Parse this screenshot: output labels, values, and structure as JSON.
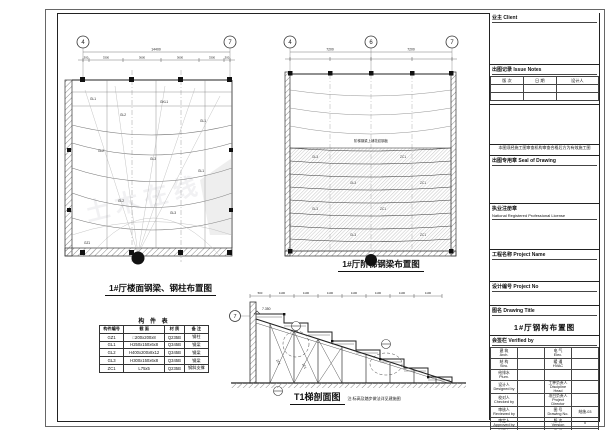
{
  "watermark": {
    "text": "土木在线"
  },
  "plan1": {
    "caption": "1#厅楼面钢梁、钢柱布置图",
    "grid_bubbles": [
      "4",
      "7"
    ],
    "dim_total": "14400",
    "dim_segments": [
      "300",
      "3300",
      "3600",
      "3600",
      "3300",
      "300"
    ],
    "labels": {
      "column": "GZ1",
      "beam1": "GL1",
      "beam2": "GL2",
      "beam3": "GKL1",
      "beam4": "GL3"
    }
  },
  "plan2": {
    "caption": "1#厅阶梯钢梁布置图",
    "grid_bubbles": [
      "4",
      "6",
      "7"
    ],
    "dims": [
      "7200",
      "7200"
    ],
    "note": "阶梯钢梁上铺花纹钢板",
    "labels": {
      "beam": "GL3",
      "brace": "ZC1"
    }
  },
  "section": {
    "caption": "T1梯剖面图",
    "note": "注:标高及踏步做法详见建施图",
    "grid_bubble": "7",
    "elevation": "7.350",
    "dim_segments": [
      "500",
      "1100",
      "1100",
      "1100",
      "1100",
      "1100",
      "1100",
      "1100"
    ],
    "labels": {
      "brace": "ZC1"
    }
  },
  "member_table": {
    "title": "构 件 表",
    "headers": [
      "构件编号",
      "截 面",
      "材 质",
      "备 注"
    ],
    "rows": [
      [
        "GZ1",
        "□200x200x8",
        "Q235B",
        "钢柱"
      ],
      [
        "GL1",
        "H250x150x6x8",
        "Q345B",
        "钢梁"
      ],
      [
        "GL2",
        "H400x200x8x12",
        "Q345B",
        "钢梁"
      ],
      [
        "GL3",
        "H300x150x6x8",
        "Q345B",
        "钢梁"
      ],
      [
        "ZC1",
        "L75x5",
        "Q235B",
        "钢斜支撑"
      ]
    ]
  },
  "titleblock": {
    "client_label": "业主  Client",
    "issue_label": "出图记录  Issue Notes",
    "issue_cols": [
      "版 次",
      "日 期",
      "设计人"
    ],
    "review_note": "本图须经施工图审查机构审查合格后方为有效施工图",
    "seal_label": "出图专用章  Seal of Drawing",
    "license_label_cn": "执业注册章",
    "license_label_en": "National Registered Professional License",
    "project_name_label": "工程名称  Project Name",
    "project_no_label": "设计编号  Project No",
    "drawing_title_label": "图名  Drawing Title",
    "drawing_title": "1#厅钢构布置图",
    "verify_label": "会签栏  Verified by",
    "verify_left": [
      "建 筑\nArch.",
      "结 构\nStru.",
      "给排水\nPlum.",
      "设计人\nDesigned by",
      "校对人\nChecked by",
      "审核人\nReviewed by",
      "审定人\nApproved by",
      "制图人\nDrawn by"
    ],
    "verify_right_labels": [
      "电 气\nElec.",
      "暖 通\nHVAC",
      "",
      "工种负责人\nDiscipline Head",
      "项目负责人\nProject Director",
      "图 号\nDrawing No.",
      "版 次\nVersion",
      "日 期\nDate"
    ],
    "verify_right_values": [
      "",
      "",
      "",
      "",
      "",
      "结施-03",
      "0",
      ""
    ]
  }
}
